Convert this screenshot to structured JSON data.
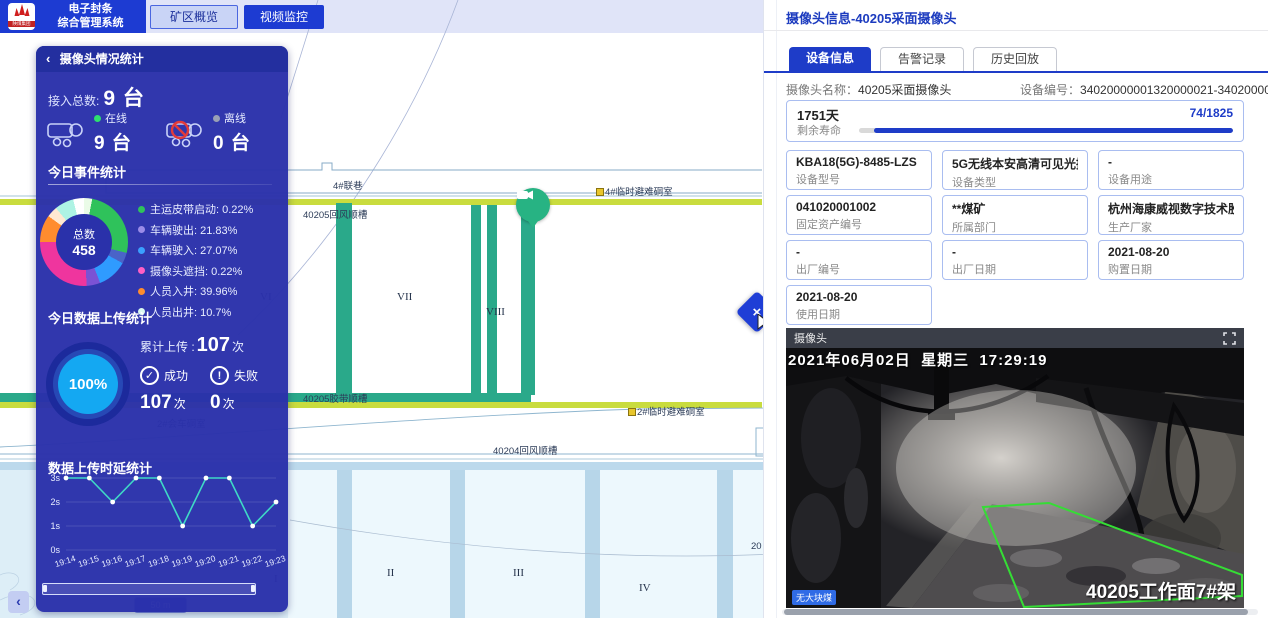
{
  "header": {
    "logo_caption": "陕煤集团",
    "app_title_line1": "电子封条",
    "app_title_line2": "综合管理系统",
    "nav": [
      {
        "label": "矿区概览",
        "active": false
      },
      {
        "label": "视频监控",
        "active": true
      }
    ]
  },
  "sidebar": {
    "back_icon": "‹",
    "title": "摄像头情况统计",
    "total_label": "接入总数:",
    "total_value": "9 台",
    "online_label": "在线",
    "online_value": "9 台",
    "offline_label": "离线",
    "offline_value": "0 台",
    "events_title": "今日事件统计",
    "upload_title": "今日数据上传统计",
    "upload_total_label": "累计上传 :",
    "upload_total_value": "107",
    "upload_total_unit": "次",
    "success_icon": "✓",
    "success_label": "成功",
    "success_value": "107",
    "success_unit": "次",
    "fail_icon": "!",
    "fail_label": "失败",
    "fail_value": "0",
    "fail_unit": "次",
    "upload_rate": "100%",
    "delay_title": "数据上传时延统计",
    "collapse_icon": "‹"
  },
  "chart_data": [
    {
      "type": "pie",
      "title": "今日事件统计",
      "center_label": "总数",
      "center_value": "458",
      "legend_position": "right",
      "slices": [
        {
          "label": "主运皮带启动",
          "value": "0.22%",
          "color": "#2fc25b"
        },
        {
          "label": "车辆驶出",
          "value": "21.83%",
          "color": "#9b8ce8"
        },
        {
          "label": "车辆驶入",
          "value": "27.07%",
          "color": "#3aa0ff"
        },
        {
          "label": "摄像头遮挡",
          "value": "0.22%",
          "color": "#ff5fc4"
        },
        {
          "label": "人员入井",
          "value": "39.96%",
          "color": "#ff8c2e"
        },
        {
          "label": "人员出井",
          "value": "10.7%",
          "color": "#d9f8f0"
        }
      ],
      "visual_segments": [
        {
          "color": "#eafbe7",
          "pct": 3
        },
        {
          "color": "#2fc25b",
          "pct": 26
        },
        {
          "color": "#4a63c8",
          "pct": 4
        },
        {
          "color": "#2f9bff",
          "pct": 11
        },
        {
          "color": "#7b52d4",
          "pct": 5
        },
        {
          "color": "#ef359e",
          "pct": 26
        },
        {
          "color": "#ff8c2e",
          "pct": 10
        },
        {
          "color": "#ffe9d2",
          "pct": 4
        },
        {
          "color": "#aef3e4",
          "pct": 7
        },
        {
          "color": "#ffffff",
          "pct": 4
        }
      ]
    },
    {
      "type": "line",
      "title": "数据上传时延统计",
      "x": [
        "19:14",
        "19:15",
        "19:16",
        "19:17",
        "19:18",
        "19:19",
        "19:20",
        "19:21",
        "19:22",
        "19:23"
      ],
      "values": [
        3,
        3,
        2,
        3,
        3,
        1,
        3,
        3,
        1,
        2
      ],
      "yticks": [
        "0s",
        "1s",
        "2s",
        "3s"
      ],
      "ylim": [
        0,
        3
      ],
      "line_color": "#3fd9c6",
      "grid": true,
      "legend_position": "none"
    }
  ],
  "map": {
    "scale_label": "50 m",
    "labels": [
      {
        "text": "4#联巷",
        "x": 333,
        "y": 178
      },
      {
        "text": "4#临时避难硐室",
        "x": 596,
        "y": 184,
        "icon": true
      },
      {
        "text": "40205回风顺槽",
        "x": 303,
        "y": 207
      },
      {
        "text": "40205胶带顺槽",
        "x": 303,
        "y": 391
      },
      {
        "text": "2#临时避难硐室",
        "x": 628,
        "y": 404,
        "icon": true
      },
      {
        "text": "40204回风顺槽",
        "x": 493,
        "y": 443
      },
      {
        "text": "2#会车硐室",
        "x": 157,
        "y": 416
      },
      {
        "text": "VII",
        "x": 397,
        "y": 291,
        "roman": true
      },
      {
        "text": "VIII",
        "x": 486,
        "y": 306,
        "roman": true
      },
      {
        "text": "VI",
        "x": 260,
        "y": 291,
        "roman": true
      },
      {
        "text": "II",
        "x": 387,
        "y": 567,
        "roman": true
      },
      {
        "text": "III",
        "x": 513,
        "y": 567,
        "roman": true
      },
      {
        "text": "IV",
        "x": 639,
        "y": 582,
        "roman": true
      },
      {
        "text": "I",
        "x": 274,
        "y": 573,
        "roman": true
      },
      {
        "text": "20",
        "x": 751,
        "y": 541
      }
    ]
  },
  "right_panel": {
    "title": "摄像头信息-40205采面摄像头",
    "close_icon": "×",
    "tabs": [
      {
        "label": "设备信息",
        "active": true
      },
      {
        "label": "告警记录",
        "active": false
      },
      {
        "label": "历史回放",
        "active": false
      }
    ],
    "name_label": "摄像头名称：",
    "name_value": "40205采面摄像头",
    "code_label": "设备编号：",
    "code_value": "34020000001320000021-34020000001320000021",
    "life": {
      "days": "1751天",
      "label": "剩余寿命",
      "ratio": "74/1825"
    },
    "cards": [
      {
        "value": "KBA18(5G)-8485-LZS",
        "label": "设备型号"
      },
      {
        "value": "5G无线本安高清可见光摄像头",
        "label": "设备类型"
      },
      {
        "value": "-",
        "label": "设备用途"
      },
      {
        "value": "041020001002",
        "label": "固定资产编号"
      },
      {
        "value": "**煤矿",
        "label": "所属部门"
      },
      {
        "value": "杭州海康威视数字技术股份有...",
        "label": "生产厂家"
      },
      {
        "value": "-",
        "label": "出厂编号"
      },
      {
        "value": "-",
        "label": "出厂日期"
      },
      {
        "value": "2021-08-20",
        "label": "购置日期"
      },
      {
        "value": "2021-08-20",
        "label": "使用日期"
      }
    ],
    "video": {
      "header": "摄像头",
      "timestamp": "2021年06月02日  星期三  17:29:19",
      "badge": "无大块煤",
      "caption": "40205工作面7#架"
    }
  },
  "colors": {
    "accent": "#1e3cc8",
    "sidebar_bg": "#2a31aa",
    "online_dot": "#2ee06e",
    "offline_dot": "#9aa0b5",
    "map_green": "#2aa98a",
    "map_yellow": "#c9dc3e",
    "chart_line": "#3fd9c6",
    "marker_green": "#27b383"
  }
}
